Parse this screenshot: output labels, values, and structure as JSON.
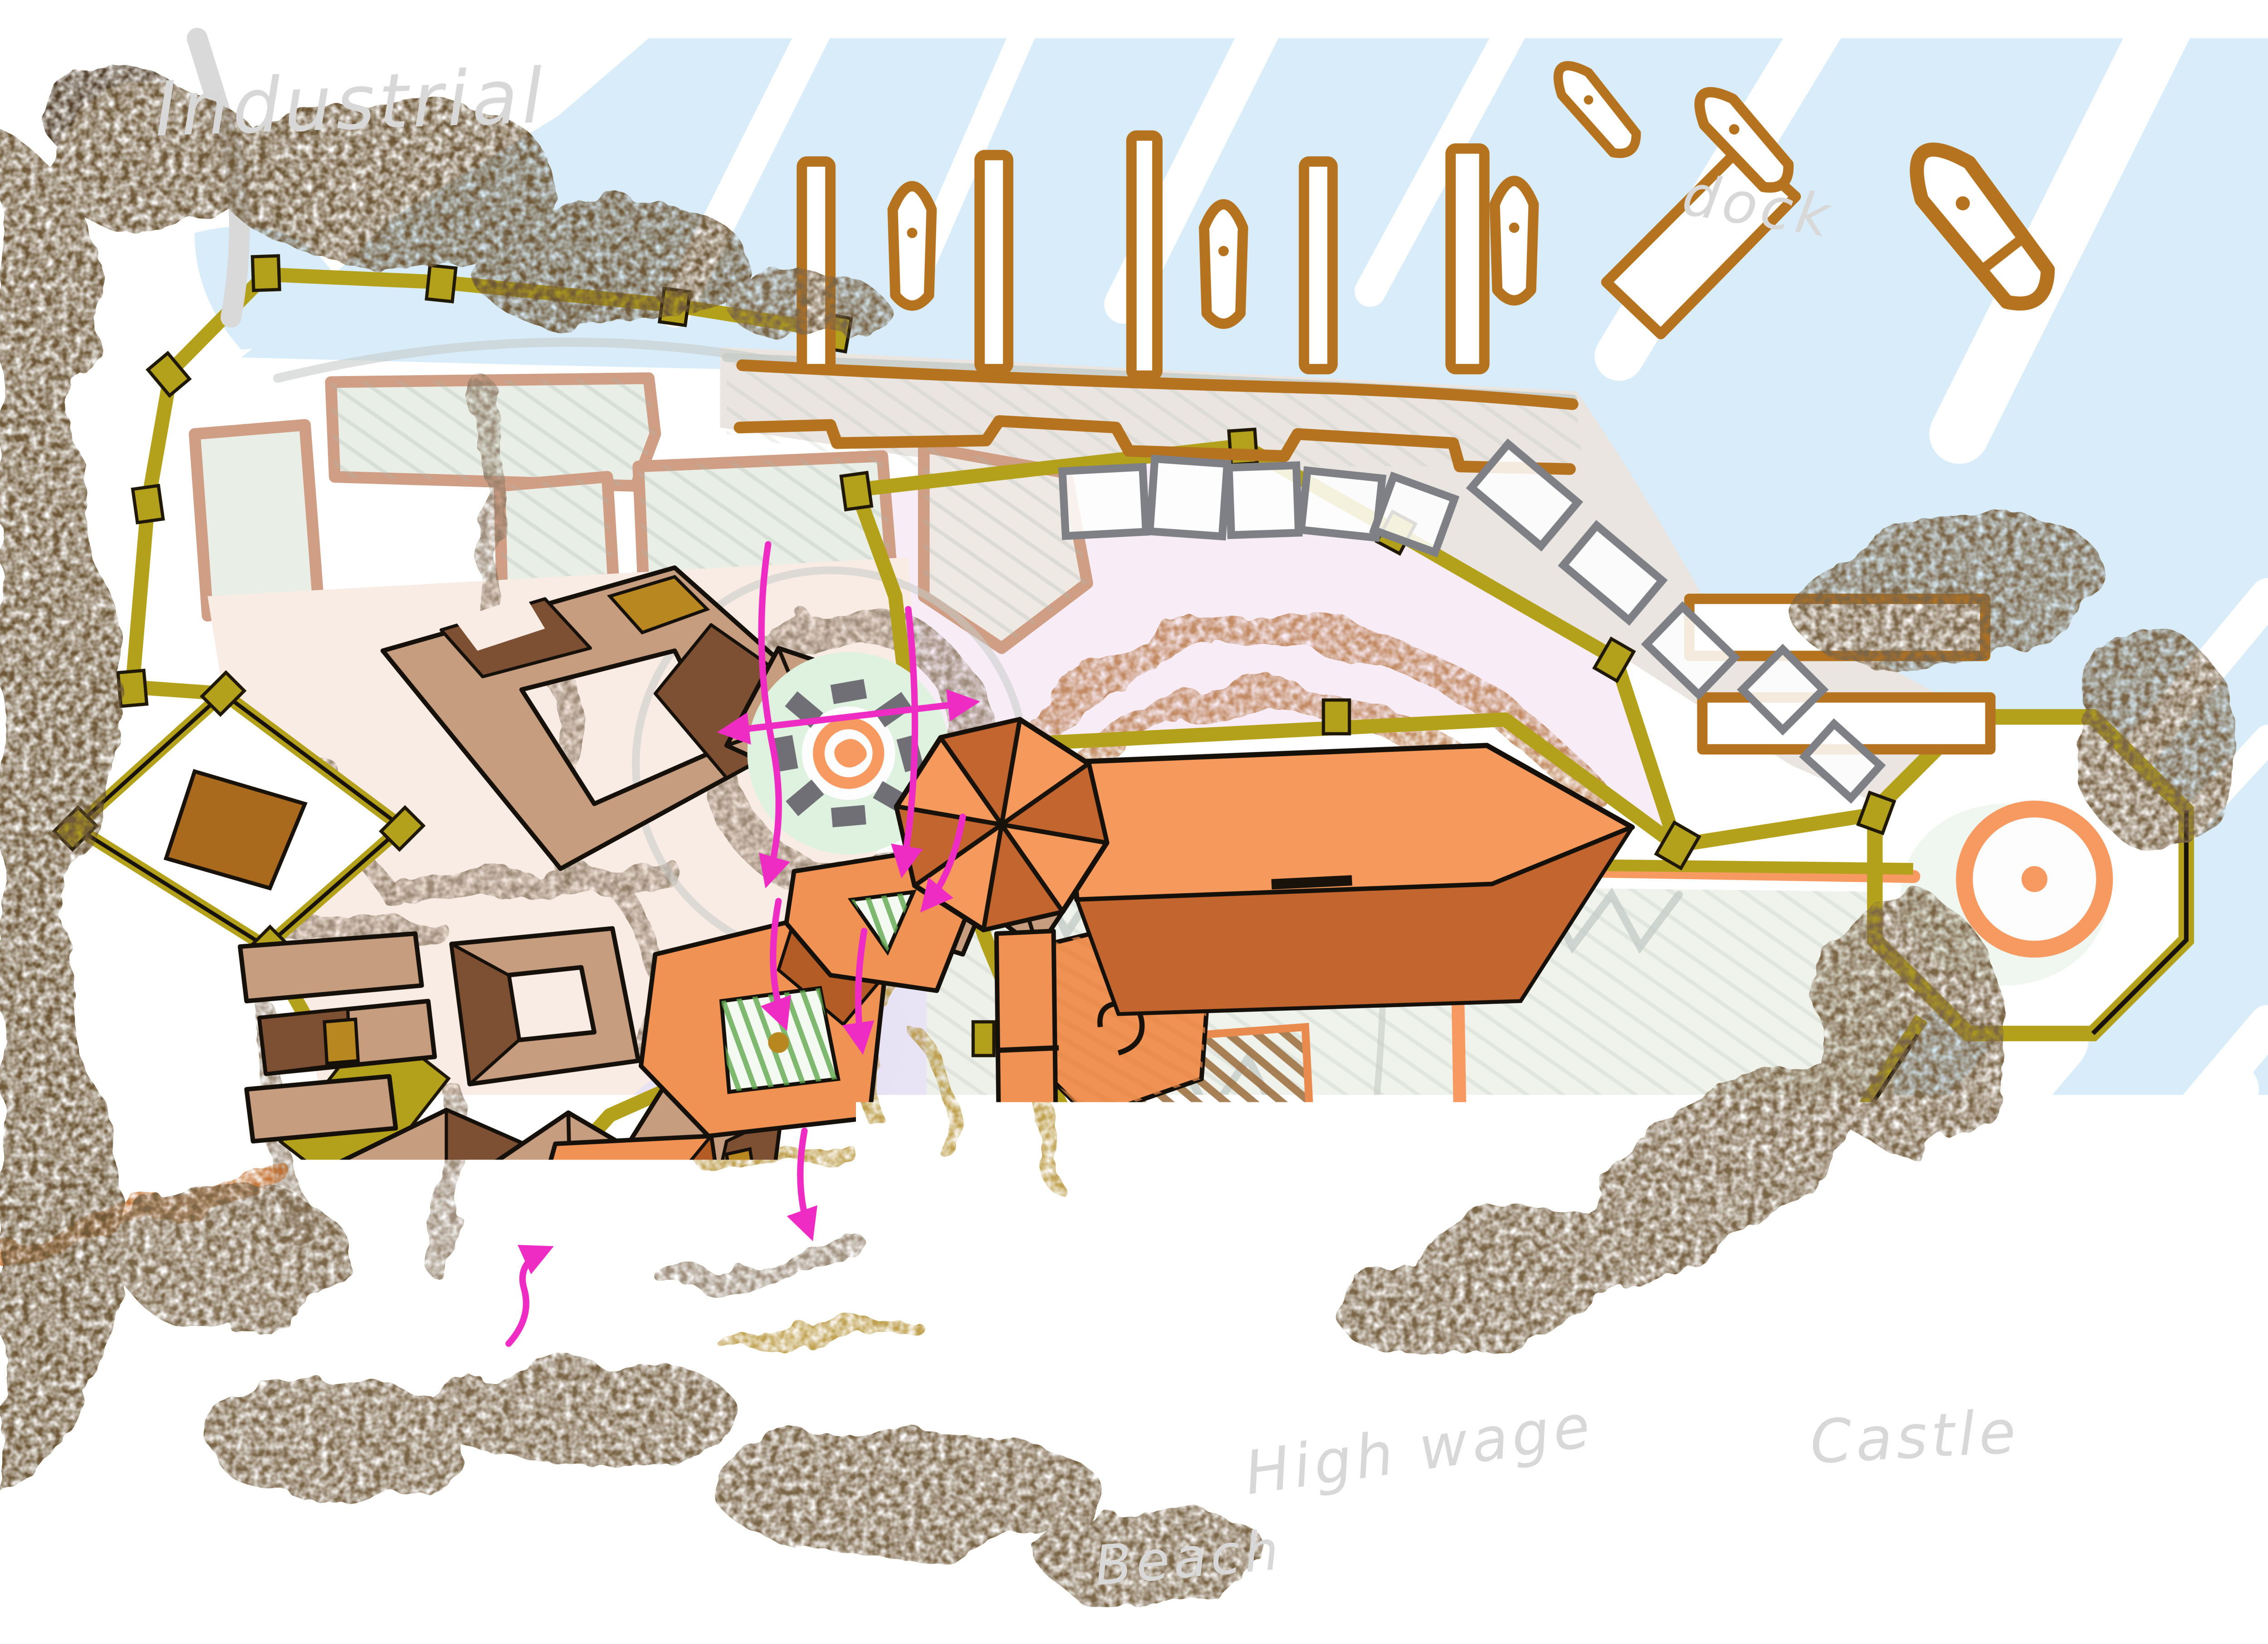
{
  "title": "Hand-drawn city planning map sketch",
  "labels": {
    "industrial": "Industrial",
    "dock": "dock",
    "high_wage": "High wage",
    "beach": "Beach",
    "castle": "Castle"
  },
  "palette": {
    "water": "#d8edf9",
    "water_streak": "#ffffff",
    "paper": "#ffffff",
    "forest": "#6e5939",
    "forest_dark": "#52402a",
    "scrub": "#7a6547",
    "wall": "#b3a11c",
    "field_outline": "#cf9e85",
    "field_fill": "#e9efe7",
    "field_green": "#d9edd2",
    "field_beige": "#efe9e3",
    "quay": "#eae5e0",
    "town_roof": "#c79d80",
    "town_roof_dark": "#7d4f33",
    "ochre": "#b8871f",
    "town_ground": "#f9ece4",
    "street": "#8d7a64",
    "orange_roof": "#ef9254",
    "orange_roof_dark": "#b35c26",
    "lavender": "#e7e3f4",
    "dirt": "#b08b28",
    "castle_orange": "#f59a5c",
    "castle_orange_dark": "#c2652f",
    "bailey_outline": "#f79a62",
    "pink_field": "#f8edf7",
    "arc_brown": "#b97a4a",
    "mint": "#dff2df",
    "stone": "#6f6f75",
    "ship_gray": "#7e8085",
    "sketch_gray": "#c6ccc8",
    "dock_brown": "#b5731f",
    "beach_sand": "#f8f4d9",
    "route": "#ee2cc4",
    "label_ink": "#d8d8d8",
    "road_orange": "#c06a28",
    "road_gray": "#d9d9d9"
  }
}
